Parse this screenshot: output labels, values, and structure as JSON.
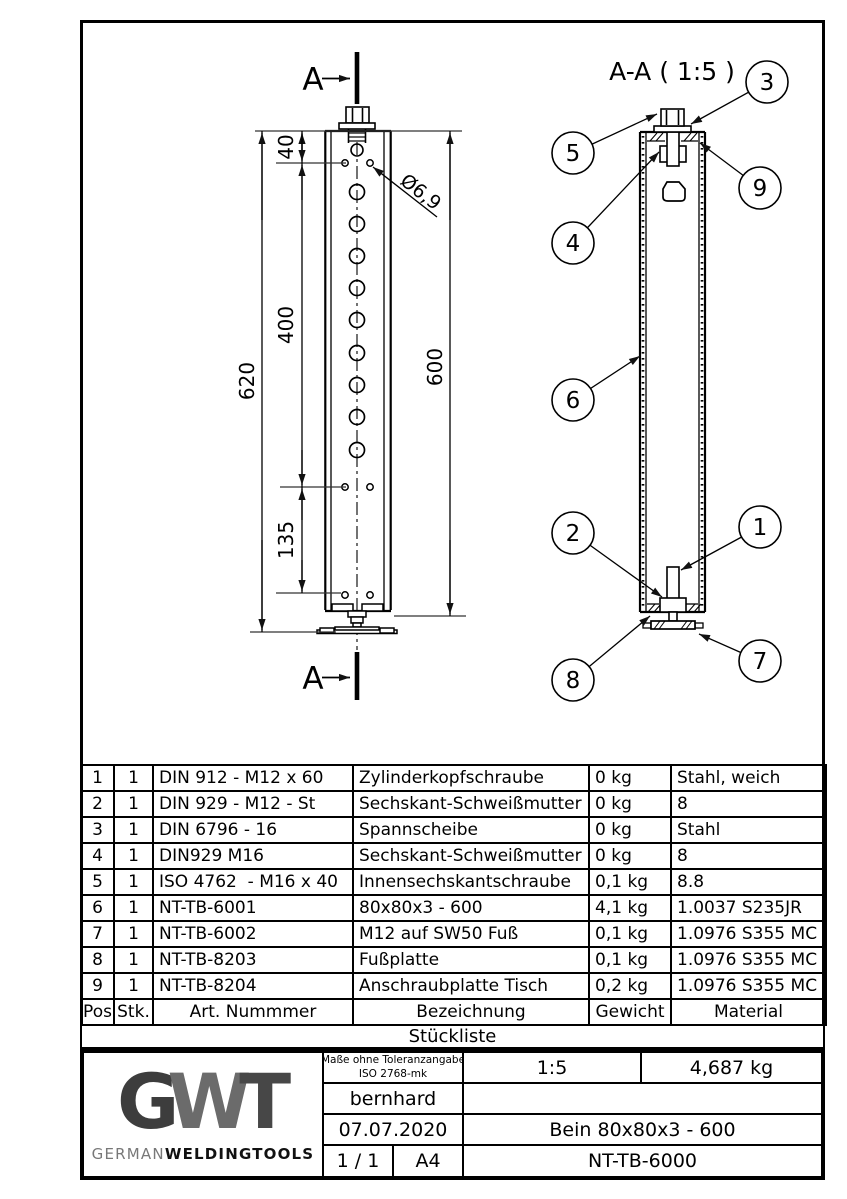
{
  "sheet": {
    "section_marker": "A",
    "front_view": {
      "dimensions": {
        "overall": "620",
        "top_offset": "40",
        "hole_span": "400",
        "foot_span": "135",
        "tube_length": "600",
        "hole_diameter": "Ø6,9"
      }
    },
    "section_view": {
      "title": "A-A ( 1:5 )",
      "balloons": [
        "1",
        "2",
        "3",
        "4",
        "5",
        "6",
        "7",
        "8",
        "9"
      ]
    }
  },
  "bom": {
    "title": "Stückliste",
    "headers": {
      "pos": "Pos",
      "qty": "Stk.",
      "part_number": "Art. Nummmer",
      "description": "Bezeichnung",
      "weight": "Gewicht",
      "material": "Material"
    },
    "rows": [
      {
        "pos": "1",
        "qty": "1",
        "part_number": "DIN 912 - M12 x 60",
        "description": "Zylinderkopfschraube",
        "weight": "0 kg",
        "material": "Stahl, weich"
      },
      {
        "pos": "2",
        "qty": "1",
        "part_number": "DIN 929 - M12 - St",
        "description": "Sechskant-Schweißmutter",
        "weight": "0 kg",
        "material": "8"
      },
      {
        "pos": "3",
        "qty": "1",
        "part_number": "DIN 6796 - 16",
        "description": "Spannscheibe",
        "weight": "0 kg",
        "material": "Stahl"
      },
      {
        "pos": "4",
        "qty": "1",
        "part_number": "DIN929 M16",
        "description": "Sechskant-Schweißmutter",
        "weight": "0 kg",
        "material": "8"
      },
      {
        "pos": "5",
        "qty": "1",
        "part_number": "ISO 4762  - M16 x 40",
        "description": "Innensechskantschraube",
        "weight": "0,1 kg",
        "material": "8.8"
      },
      {
        "pos": "6",
        "qty": "1",
        "part_number": "NT-TB-6001",
        "description": "80x80x3 - 600",
        "weight": "4,1 kg",
        "material": "1.0037 S235JR"
      },
      {
        "pos": "7",
        "qty": "1",
        "part_number": "NT-TB-6002",
        "description": "M12 auf SW50 Fuß",
        "weight": "0,1 kg",
        "material": "1.0976 S355 MC"
      },
      {
        "pos": "8",
        "qty": "1",
        "part_number": "NT-TB-8203",
        "description": "Fußplatte",
        "weight": "0,1 kg",
        "material": "1.0976 S355 MC"
      },
      {
        "pos": "9",
        "qty": "1",
        "part_number": "NT-TB-8204",
        "description": "Anschraubplatte Tisch",
        "weight": "0,2 kg",
        "material": "1.0976 S355 MC"
      }
    ]
  },
  "title_block": {
    "tolerance_line1": "Maße ohne Toleranzangabe",
    "tolerance_line2": "ISO 2768-mk",
    "scale": "1:5",
    "weight": "4,687 kg",
    "author": "bernhard",
    "date": "07.07.2020",
    "part_title": "Bein 80x80x3 - 600",
    "sheet": "1 / 1",
    "format": "A4",
    "drawing_number": "NT-TB-6000",
    "logo": {
      "letter_g": "G",
      "letter_w": "W",
      "letter_t": "T",
      "name_light": "GERMAN",
      "name_bold": "WELDINGTOOLS"
    }
  }
}
